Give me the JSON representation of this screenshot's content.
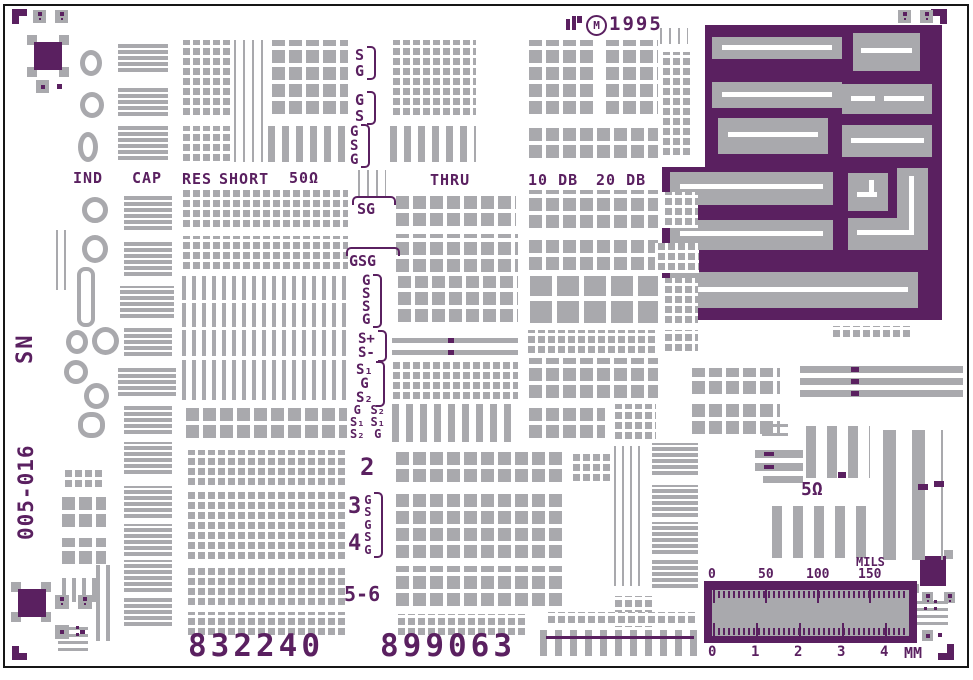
{
  "colors": {
    "purple": "#5a2060",
    "gray": "#a9a9ad",
    "white": "#ffffff"
  },
  "header": {
    "mark": "M",
    "year": "1995"
  },
  "side": {
    "sn": "SN",
    "part_number": "005-016"
  },
  "columns": {
    "ind": "IND",
    "cap": "CAP",
    "res": "RES",
    "short": "SHORT",
    "fifty_ohm": "50Ω",
    "thru": "THRU",
    "db10": "10 DB",
    "db20": "20 DB"
  },
  "probe_labels": {
    "g1": [
      "S",
      "G"
    ],
    "g2": [
      "G",
      "S"
    ],
    "g3": [
      "G",
      "S",
      "G"
    ],
    "sg": "SG",
    "gsg": "GSG",
    "g6": [
      "G",
      "S",
      "S",
      "G"
    ],
    "g7": [
      "S+",
      "S-"
    ],
    "g8": [
      "S₁",
      "G",
      "S₂"
    ],
    "g9a": [
      "G",
      "S₁",
      "S₂"
    ],
    "g9b": [
      "S₂",
      "S₁",
      "G"
    ],
    "n2": "2",
    "n3": "3",
    "n4": "4",
    "g11": [
      "G",
      "S",
      "G",
      "S",
      "G"
    ],
    "n56": "5-6"
  },
  "serials": {
    "left": "832240",
    "right": "899063"
  },
  "annotations": {
    "five_ohm": "5Ω"
  },
  "ruler": {
    "unit_top": "MILS",
    "top_ticks": [
      "0",
      "50",
      "100",
      "150"
    ],
    "bottom_ticks": [
      "0",
      "1",
      "2",
      "3",
      "4"
    ],
    "unit_bottom": "MM"
  },
  "shapes": [
    [
      12,
      9,
      15,
      7,
      "p"
    ],
    [
      12,
      9,
      7,
      15,
      "p"
    ],
    [
      931,
      9,
      16,
      7,
      "p"
    ],
    [
      940,
      9,
      7,
      15,
      "p"
    ],
    [
      12,
      646,
      7,
      14,
      "p"
    ],
    [
      12,
      653,
      15,
      7,
      "p"
    ],
    [
      947,
      644,
      7,
      16,
      "p"
    ],
    [
      938,
      653,
      16,
      7,
      "p"
    ],
    [
      27,
      35,
      10,
      10,
      "g"
    ],
    [
      59,
      35,
      10,
      10,
      "g"
    ],
    [
      27,
      67,
      10,
      10,
      "g"
    ],
    [
      59,
      67,
      10,
      10,
      "g"
    ],
    [
      34,
      42,
      28,
      28,
      "p"
    ],
    [
      57,
      84,
      5,
      5,
      "p"
    ],
    [
      11,
      582,
      10,
      10,
      "g"
    ],
    [
      41,
      582,
      10,
      10,
      "g"
    ],
    [
      11,
      612,
      10,
      10,
      "g"
    ],
    [
      41,
      612,
      10,
      10,
      "g"
    ],
    [
      18,
      589,
      28,
      28,
      "p"
    ],
    [
      80,
      630,
      5,
      5,
      "p"
    ],
    [
      910,
      584,
      9,
      9,
      "g"
    ],
    [
      944,
      550,
      9,
      9,
      "g"
    ],
    [
      920,
      556,
      26,
      30,
      "p"
    ],
    [
      938,
      633,
      4,
      4,
      "p"
    ],
    [
      916,
      601,
      32,
      3,
      "g"
    ],
    [
      916,
      608,
      32,
      3,
      "g"
    ],
    [
      916,
      615,
      32,
      3,
      "g"
    ],
    [
      916,
      622,
      32,
      3,
      "g"
    ],
    [
      924,
      600,
      3,
      3,
      "p"
    ],
    [
      934,
      600,
      3,
      3,
      "p"
    ],
    [
      924,
      607,
      3,
      3,
      "p"
    ],
    [
      934,
      607,
      3,
      3,
      "p"
    ],
    [
      58,
      627,
      30,
      3,
      "g"
    ],
    [
      58,
      634,
      30,
      3,
      "g"
    ],
    [
      58,
      641,
      30,
      3,
      "g"
    ],
    [
      58,
      648,
      30,
      3,
      "g"
    ],
    [
      66,
      626,
      3,
      3,
      "p"
    ],
    [
      76,
      626,
      3,
      3,
      "p"
    ],
    [
      66,
      633,
      3,
      3,
      "p"
    ],
    [
      76,
      633,
      3,
      3,
      "p"
    ],
    [
      566,
      19,
      4,
      11,
      "p"
    ],
    [
      572,
      16,
      4,
      14,
      "p"
    ],
    [
      577,
      16,
      5,
      7,
      "p"
    ],
    [
      705,
      25,
      237,
      142,
      "p"
    ],
    [
      662,
      167,
      280,
      153,
      "p"
    ],
    [
      712,
      37,
      130,
      22,
      "g"
    ],
    [
      853,
      33,
      67,
      38,
      "g"
    ],
    [
      712,
      82,
      130,
      26,
      "g"
    ],
    [
      842,
      84,
      90,
      30,
      "g"
    ],
    [
      718,
      118,
      110,
      36,
      "g"
    ],
    [
      842,
      125,
      90,
      32,
      "g"
    ],
    [
      670,
      172,
      163,
      33,
      "g"
    ],
    [
      848,
      173,
      40,
      38,
      "g"
    ],
    [
      897,
      168,
      31,
      82,
      "g"
    ],
    [
      848,
      218,
      80,
      32,
      "g"
    ],
    [
      670,
      220,
      163,
      30,
      "g"
    ],
    [
      670,
      272,
      248,
      36,
      "g"
    ],
    [
      722,
      45,
      110,
      5,
      "w"
    ],
    [
      861,
      48,
      51,
      5,
      "w"
    ],
    [
      722,
      92,
      110,
      5,
      "w"
    ],
    [
      851,
      96,
      24,
      5,
      "w"
    ],
    [
      884,
      96,
      40,
      5,
      "w"
    ],
    [
      728,
      132,
      90,
      5,
      "w"
    ],
    [
      851,
      138,
      73,
      5,
      "w"
    ],
    [
      680,
      184,
      143,
      5,
      "w"
    ],
    [
      857,
      192,
      20,
      5,
      "w"
    ],
    [
      869,
      180,
      5,
      17,
      "w"
    ],
    [
      909,
      176,
      5,
      59,
      "w"
    ],
    [
      857,
      230,
      57,
      5,
      "w"
    ],
    [
      680,
      231,
      143,
      5,
      "w"
    ],
    [
      680,
      287,
      228,
      5,
      "w"
    ],
    [
      392,
      338,
      126,
      5,
      "g"
    ],
    [
      448,
      338,
      6,
      5,
      "p"
    ],
    [
      392,
      350,
      126,
      5,
      "g"
    ],
    [
      448,
      350,
      6,
      5,
      "p"
    ],
    [
      800,
      366,
      163,
      7,
      "g"
    ],
    [
      851,
      367,
      8,
      5,
      "p"
    ],
    [
      800,
      378,
      163,
      7,
      "g"
    ],
    [
      851,
      379,
      8,
      5,
      "p"
    ],
    [
      800,
      390,
      163,
      7,
      "g"
    ],
    [
      851,
      391,
      8,
      5,
      "p"
    ],
    [
      755,
      450,
      48,
      8,
      "g"
    ],
    [
      764,
      452,
      10,
      4,
      "p"
    ],
    [
      755,
      463,
      48,
      8,
      "g"
    ],
    [
      764,
      465,
      10,
      4,
      "p"
    ],
    [
      763,
      476,
      40,
      7,
      "g"
    ],
    [
      704,
      581,
      213,
      62,
      "p"
    ],
    [
      712,
      590,
      197,
      46,
      "g"
    ],
    [
      713,
      590,
      2,
      13,
      "p"
    ],
    [
      765,
      590,
      2,
      13,
      "p"
    ],
    [
      817,
      590,
      2,
      13,
      "p"
    ],
    [
      869,
      590,
      2,
      13,
      "p"
    ],
    [
      713,
      623,
      2,
      13,
      "p"
    ],
    [
      756,
      623,
      2,
      13,
      "p"
    ],
    [
      799,
      623,
      2,
      13,
      "p"
    ],
    [
      842,
      623,
      2,
      13,
      "p"
    ],
    [
      885,
      623,
      2,
      13,
      "p"
    ]
  ],
  "blocks": [
    [
      "pads-sm",
      180,
      40,
      52,
      78
    ],
    [
      "pads-sm",
      180,
      126,
      52,
      38
    ],
    [
      "vlines",
      234,
      40,
      30,
      122
    ],
    [
      "pads-md",
      268,
      40,
      80,
      78
    ],
    [
      "vbars-md",
      268,
      126,
      80,
      36
    ],
    [
      "pads-sm",
      390,
      40,
      86,
      78
    ],
    [
      "vbars-md",
      390,
      126,
      86,
      36
    ],
    [
      "pads-md",
      525,
      40,
      72,
      78
    ],
    [
      "pads-md",
      602,
      40,
      56,
      78
    ],
    [
      "pads-md",
      525,
      126,
      133,
      36
    ],
    [
      "vlines",
      660,
      28,
      28,
      16
    ],
    [
      "pads-sm",
      660,
      52,
      30,
      106
    ],
    [
      "cap",
      118,
      42,
      50,
      32
    ],
    [
      "cap",
      118,
      86,
      50,
      32
    ],
    [
      "cap",
      118,
      126,
      50,
      36
    ],
    [
      "vlines",
      358,
      170,
      28,
      26
    ],
    [
      "pads-sm",
      180,
      190,
      168,
      40
    ],
    [
      "pads-md",
      392,
      194,
      124,
      36
    ],
    [
      "pads-md",
      525,
      190,
      133,
      42
    ],
    [
      "pads-sm",
      662,
      192,
      36,
      36
    ],
    [
      "pads-sm",
      180,
      236,
      168,
      36
    ],
    [
      "pads-md",
      392,
      234,
      126,
      42
    ],
    [
      "pads-md",
      525,
      236,
      133,
      38
    ],
    [
      "pads-sm",
      655,
      243,
      44,
      30
    ],
    [
      "vbars-sm",
      182,
      276,
      165,
      24
    ],
    [
      "vbars-sm",
      182,
      303,
      165,
      24
    ],
    [
      "pads-md",
      394,
      276,
      124,
      50
    ],
    [
      "pads-lg",
      525,
      276,
      133,
      52
    ],
    [
      "pads-sm",
      662,
      278,
      36,
      48
    ],
    [
      "vbars-sm",
      182,
      330,
      165,
      26
    ],
    [
      "pads-sm",
      525,
      330,
      133,
      26
    ],
    [
      "pads-sm",
      662,
      330,
      36,
      24
    ],
    [
      "vbars-sm",
      182,
      360,
      165,
      40
    ],
    [
      "pads-sm",
      390,
      360,
      128,
      42
    ],
    [
      "pads-md",
      525,
      358,
      133,
      44
    ],
    [
      "pads-md",
      688,
      368,
      92,
      30
    ],
    [
      "pads-md",
      182,
      404,
      165,
      38
    ],
    [
      "vbars-md",
      392,
      404,
      124,
      38
    ],
    [
      "pads-md",
      525,
      404,
      80,
      38
    ],
    [
      "pads-sm",
      612,
      404,
      44,
      38
    ],
    [
      "pads-md",
      688,
      404,
      92,
      34
    ],
    [
      "pads-sm",
      185,
      450,
      160,
      38
    ],
    [
      "pads-md",
      392,
      450,
      170,
      36
    ],
    [
      "pads-sm",
      570,
      452,
      40,
      32
    ],
    [
      "cap",
      652,
      443,
      46,
      34
    ],
    [
      "hlines",
      762,
      418,
      26,
      18
    ],
    [
      "vbars-lg",
      806,
      426,
      64,
      52
    ],
    [
      "vbars-xl",
      883,
      430,
      60,
      130
    ],
    [
      "vbars-lg",
      772,
      506,
      100,
      52
    ],
    [
      "pads-sm",
      185,
      490,
      160,
      72
    ],
    [
      "pads-md",
      392,
      490,
      170,
      72
    ],
    [
      "cap",
      652,
      485,
      46,
      34
    ],
    [
      "cap",
      652,
      522,
      46,
      34
    ],
    [
      "cap",
      652,
      558,
      46,
      32
    ],
    [
      "vbars-thin",
      614,
      446,
      32,
      140
    ],
    [
      "pads-sm",
      185,
      566,
      160,
      42
    ],
    [
      "pads-md",
      392,
      566,
      170,
      44
    ],
    [
      "pads-sm",
      612,
      596,
      42,
      34
    ],
    [
      "pads-sm",
      185,
      612,
      160,
      26
    ],
    [
      "pads-sm",
      395,
      614,
      132,
      24
    ],
    [
      "pads-sm",
      545,
      612,
      150,
      14
    ],
    [
      "comb",
      540,
      630,
      160,
      26
    ],
    [
      "pads-sm",
      830,
      326,
      80,
      14
    ],
    [
      "pads-sm",
      62,
      468,
      40,
      22
    ],
    [
      "pads-md",
      58,
      495,
      48,
      36
    ],
    [
      "pads-md",
      58,
      538,
      48,
      30
    ],
    [
      "vbars-sm",
      62,
      578,
      34,
      24
    ],
    [
      "vbars-sm",
      96,
      565,
      16,
      76
    ],
    [
      "vbars-thin",
      56,
      230,
      16,
      60
    ],
    [
      "ticks",
      713,
      591,
      195,
      7
    ],
    [
      "ticks",
      713,
      628,
      195,
      7
    ],
    [
      "cap",
      124,
      194,
      48,
      38
    ],
    [
      "cap",
      124,
      240,
      48,
      38
    ],
    [
      "cap",
      120,
      286,
      54,
      34
    ],
    [
      "cap",
      124,
      328,
      48,
      30
    ],
    [
      "cap",
      118,
      366,
      58,
      32
    ],
    [
      "cap",
      124,
      404,
      48,
      32
    ],
    [
      "cap",
      124,
      442,
      48,
      34
    ],
    [
      "cap",
      124,
      486,
      48,
      34
    ],
    [
      "cap",
      124,
      524,
      48,
      34
    ],
    [
      "cap",
      124,
      560,
      48,
      34
    ],
    [
      "cap",
      124,
      598,
      48,
      30
    ]
  ],
  "accents": [
    [
      546,
      636,
      148,
      3,
      "p"
    ],
    [
      918,
      484,
      10,
      6,
      "p"
    ],
    [
      934,
      481,
      10,
      6,
      "p"
    ],
    [
      838,
      472,
      8,
      6,
      "p"
    ]
  ],
  "loops": [
    {
      "x": 80,
      "y": 50,
      "w": 22,
      "h": 26
    },
    {
      "x": 80,
      "y": 92,
      "w": 24,
      "h": 26
    },
    {
      "x": 78,
      "y": 132,
      "w": 20,
      "h": 30
    },
    {
      "x": 82,
      "y": 197,
      "w": 26,
      "h": 26
    },
    {
      "x": 82,
      "y": 235,
      "w": 26,
      "h": 28
    },
    {
      "x": 77,
      "y": 267,
      "w": 18,
      "h": 60,
      "br": "8px",
      "bw": 4
    },
    {
      "x": 66,
      "y": 330,
      "w": 22,
      "h": 24
    },
    {
      "x": 92,
      "y": 327,
      "w": 27,
      "h": 28
    },
    {
      "x": 64,
      "y": 360,
      "w": 24,
      "h": 24
    },
    {
      "x": 84,
      "y": 383,
      "w": 25,
      "h": 26
    },
    {
      "x": 78,
      "y": 412,
      "w": 27,
      "h": 26,
      "br": "45%"
    }
  ],
  "xsquares": [
    [
      33,
      10,
      13
    ],
    [
      55,
      10,
      13
    ],
    [
      898,
      10,
      13
    ],
    [
      920,
      10,
      13
    ],
    [
      55,
      595,
      14
    ],
    [
      78,
      595,
      14
    ],
    [
      922,
      592,
      11
    ],
    [
      944,
      592,
      11
    ]
  ],
  "dsquares": [
    [
      36,
      80,
      13
    ],
    [
      55,
      625,
      14
    ],
    [
      922,
      630,
      11
    ]
  ]
}
